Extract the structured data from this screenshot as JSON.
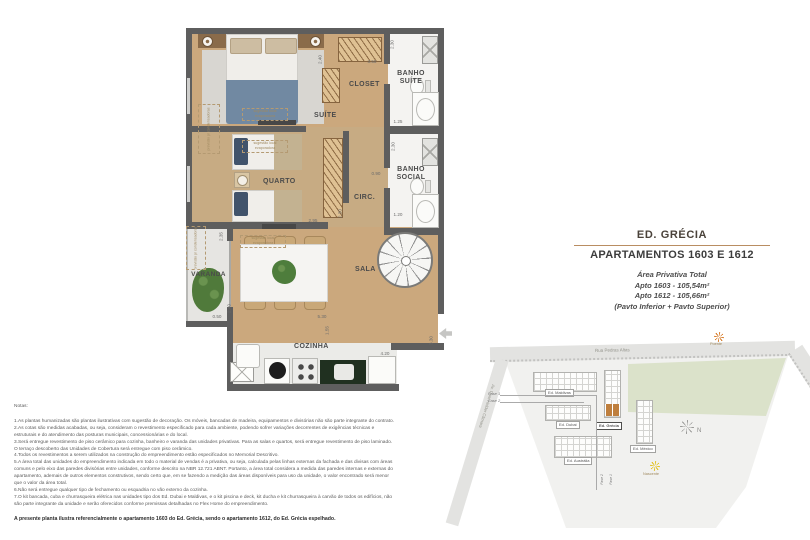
{
  "plan": {
    "rooms": {
      "suite": "SUÍTE",
      "closet": "CLOSET",
      "banho_suite_l1": "BANHO",
      "banho_suite_l2": "SUÍTE",
      "quarto": "QUARTO",
      "circ": "CIRC.",
      "banho_social_l1": "BANHO",
      "banho_social_l2": "SOCIAL",
      "varanda": "VARANDA",
      "sala": "SALA",
      "cozinha": "COZINHA"
    },
    "dims": [
      "2.40",
      "3.55",
      "2.30",
      "1.25",
      "0.90",
      "2.30",
      "1.20",
      "2.95",
      "2.30",
      "2.35",
      "0.50",
      "2.40",
      "5.30",
      "1.55",
      "4.20",
      "3.30"
    ],
    "annotations": {
      "condensadoras": "previsão p/ condensadoras",
      "evaporadora_l1": "sugestão local",
      "evaporadora_l2": "evaporadora"
    }
  },
  "title_block": {
    "building": "ED. GRÉCIA",
    "apartments": "APARTAMENTOS 1603 E 1612",
    "area_title": "Área Privativa Total",
    "area_line1": "Apto 1603 - 105,54m²",
    "area_line2": "Apto 1612 - 105,66m²",
    "area_line3": "(Pavto Inferior + Pavto Superior)"
  },
  "siteplan": {
    "streets": {
      "top": "Rua Pedras Altas",
      "left": "Av. Dom Helder Câmara",
      "right": "Rua Degas"
    },
    "buildings": {
      "maldivas": "Ed. Maldivas",
      "dubai": "Ed. Dubai",
      "australia": "Ed. Austrália",
      "grecia": "Ed. Grécia",
      "mexico": "Ed. México"
    },
    "compass": "N",
    "poente": "Poente",
    "nascente": "Nascente",
    "fase1": "Fase 1",
    "fase2": "Fase 2",
    "fase_v1": "Fase 2",
    "fase_v2": "Fase 1"
  },
  "notes": {
    "heading": "Notas:",
    "items": [
      "1.As plantas humanizadas são plantas ilustrativas com sugestão de decoração. Os móveis, bancadas de madeira, equipamentos e divisórias não são parte integrante do contrato.",
      "2.As cotas são medidas acabadas, ou seja, consideram o revestimento especificado para cada ambiente, podendo sofrer variações decorrentes de exigências técnicas e estruturais e do atendimento das posturas municipais, concessionárias e do local.",
      "3.Será entregue revestimento de piso cerâmico para cozinha, banheiro e varanda das unidades privativas. Para as salas e quartos, será entregue revestimento de piso laminado. O terraço descoberto das Unidades de Cobertura será entregue com piso cerâmico.",
      "4.Todos os revestimentos a serem utilizados na construção do empreendimento estão especificados no Memorial Descritivo.",
      "5.A área total das unidades do empreendimento indicada em todo o material de vendas é a privativa, ou seja, calculada pelas linhas externas da fachada  e das divisas com áreas comuns e pelo eixo das paredes divisórias entre unidades, conforme descrito na NBR 12.721 ABNT. Portanto, a área total considera a medida das paredes internas e externas do apartamento, ademais de outros elementos construtivos, sendo certo que, em se fazendo a medição das áreas disponíveis para uso da unidade, o valor encontrado será menor que o valor da área total.",
      "6.Não será entregue qualquer tipo de fechamento ou esquadria no vão externo da cozinha.",
      "7.O kit bancada, cuba e churrasqueira elétrica nas unidades tipo dos Ed. Dubai e Maldivas, e o kit piscina e deck, kit ducha e kit churrasqueira à carvão de todos os edifícios, não são parte integrante da unidade e serão oferecidos conforme premissas detalhadas no Flex Home do empreendimento."
    ],
    "footer": "A presente planta ilustra referencialmente o apartamento 1603 do Ed. Grécia, sendo o apartamento 1612, do Ed. Grécia espelhado."
  }
}
